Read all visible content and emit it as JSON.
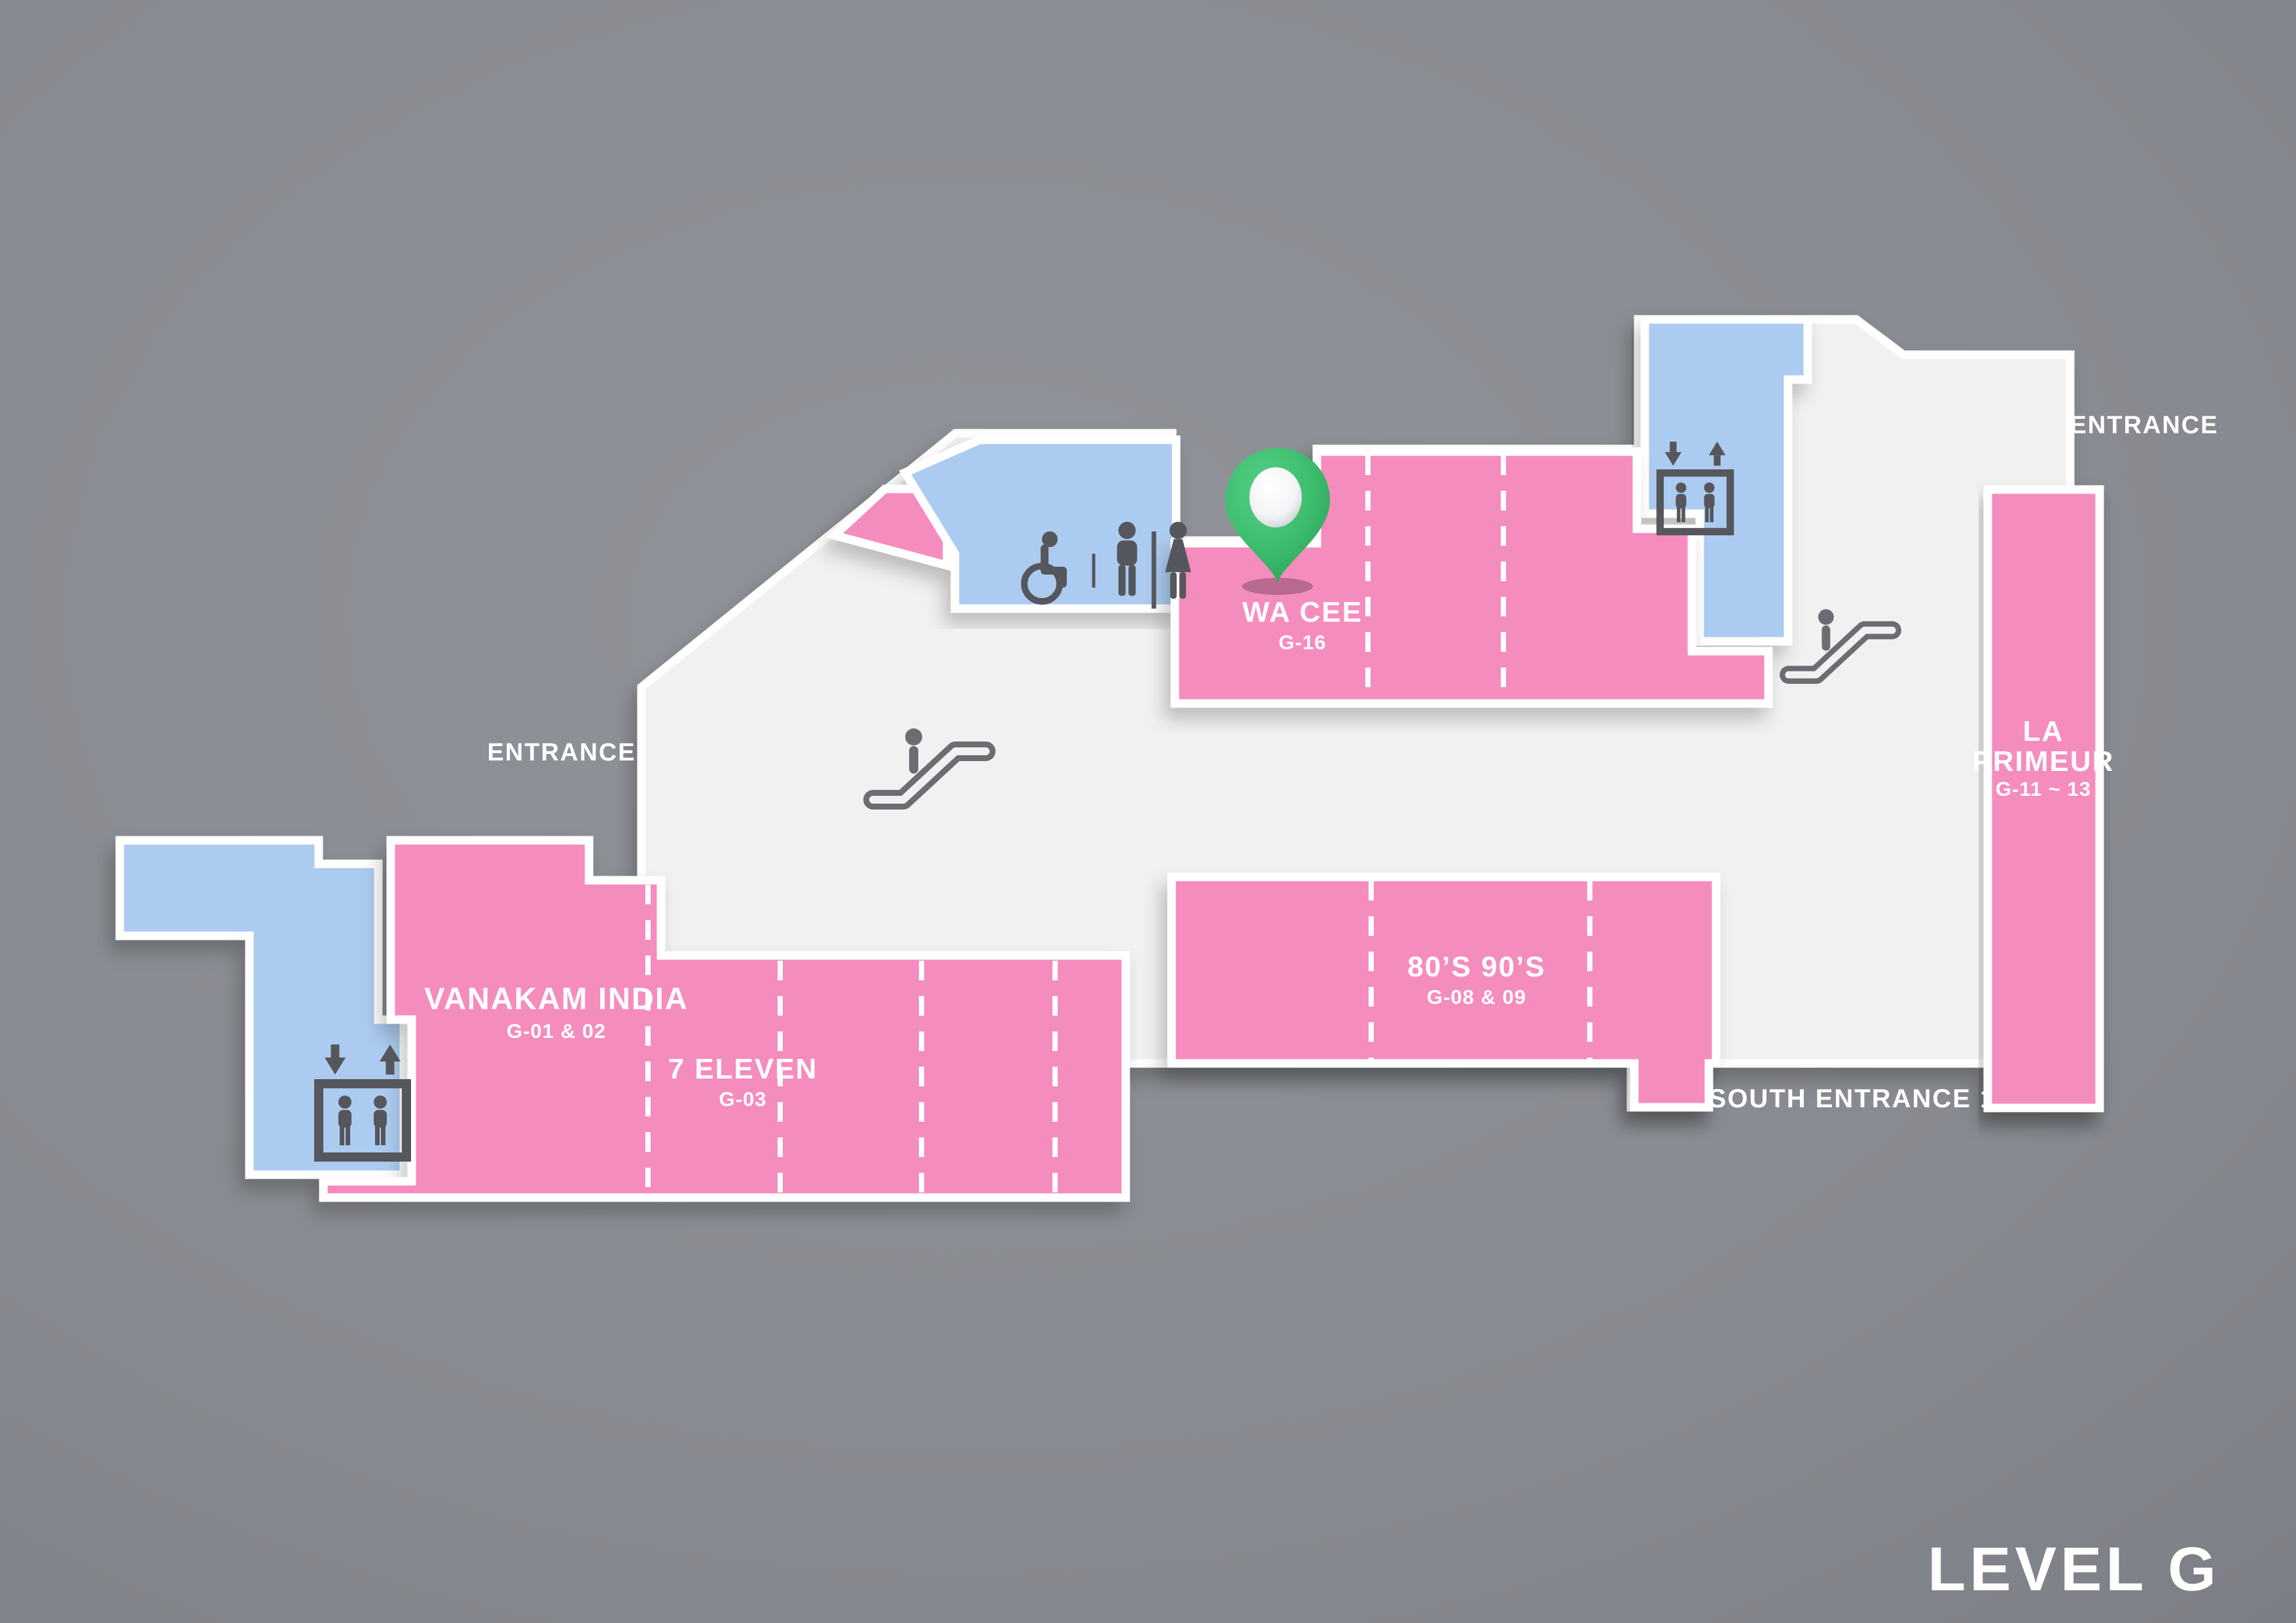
{
  "title": {
    "level": "LEVEL G"
  },
  "labels": {
    "entrance_left": "ENTRANCE",
    "entrance_right": "ENTRANCE",
    "south_entrance": "SOUTH ENTRANCE 1"
  },
  "stores": {
    "wa_cee": {
      "name": "WA CEE",
      "unit": "G-16"
    },
    "vanakam_india": {
      "name": "VANAKAM INDIA",
      "unit": "G-01 & 02"
    },
    "seven_eleven": {
      "name": "7 ELEVEN",
      "unit": "G-03"
    },
    "eighties_nineties": {
      "name": "80’S 90’S",
      "unit": "G-08 & 09"
    },
    "la_primeur": {
      "name_line1": "LA",
      "name_line2": "PRIMEUR",
      "unit": "G-11 ~ 13"
    }
  },
  "icons": {
    "pin": "location-pin",
    "escalator": "escalator",
    "elevator": "elevator",
    "wheelchair": "accessible-toilet",
    "men": "mens-toilet",
    "women": "womens-toilet"
  },
  "colors": {
    "background": "#8A8D92",
    "floor": "#F1F1F2",
    "store_pink": "#F58CBE",
    "facility_blue": "#ACCBF0",
    "border_white": "#FFFFFF",
    "icon_gray": "#55575C",
    "escalator_gray": "#6B6D72",
    "pin_green": "#3DBE6F",
    "label_white": "#FFFFFF"
  }
}
